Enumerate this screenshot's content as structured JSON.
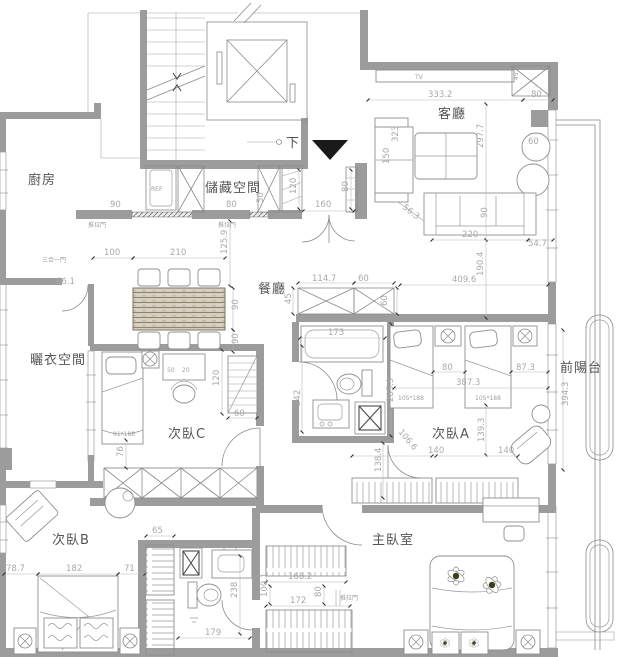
{
  "rooms": {
    "kitchen": "廚房",
    "storage": "儲藏空間",
    "living": "客廳",
    "dining": "餐廳",
    "drying": "曬衣空間",
    "bedroom_c": "次臥C",
    "bedroom_a": "次臥A",
    "bedroom_b": "次臥B",
    "master": "主臥室",
    "balcony": "前陽台"
  },
  "labels": {
    "down": "下",
    "tv": "TV",
    "ref": "REF",
    "sliding1": "推拉門",
    "sliding2": "推拉門",
    "sliding3": "推拉門",
    "triple_door": "三合一門"
  },
  "furniture_tags": {
    "bed_c": "91*188",
    "bed_a1": "105*188",
    "bed_a2": "105*188"
  },
  "dims": {
    "k_door": "90",
    "s_door": "80",
    "s_side": "50",
    "dine_off": "100",
    "dine_w": "210",
    "dine_h": "125.9",
    "table_d": "90",
    "table_d2": "90",
    "triple": "66.1",
    "lv_w": "333.2",
    "lv_n": "80",
    "lv_h": "297.7",
    "sofa_b": "323",
    "sofa_d": "150",
    "niche_d": "45",
    "tbl_r": "60",
    "sofa2_w": "220",
    "sofa2_d": "90",
    "lv_r": "54.7",
    "en_w": "160",
    "en_h": "120",
    "en_s": "80",
    "en_g": "56.3",
    "ut_w": "114.7",
    "ut_w2": "60",
    "ut_h": "45",
    "ut_h2": "60",
    "hall_w": "409.6",
    "hall_h": "190.4",
    "b1_w": "173",
    "b1_h": "242",
    "b1_d": "285.9",
    "a_g1": "80",
    "a_g2": "87.3",
    "a_w": "387.3",
    "a_h": "139.3",
    "a_s1": "140",
    "a_s2": "140",
    "a_d": "106.6",
    "a_e": "138.4",
    "balc": "394.3",
    "c_shelf": "120",
    "c_s": "60",
    "c_g": "76",
    "c_d1": "50",
    "c_d2": "20",
    "b_l": "78.7",
    "b_w": "182",
    "b_r": "71",
    "b_c": "65",
    "b2_w": "179",
    "b2_h": "238",
    "mc_t": "168.2",
    "mc_h": "100.1",
    "mc_b": "172",
    "mc_r": "80"
  }
}
